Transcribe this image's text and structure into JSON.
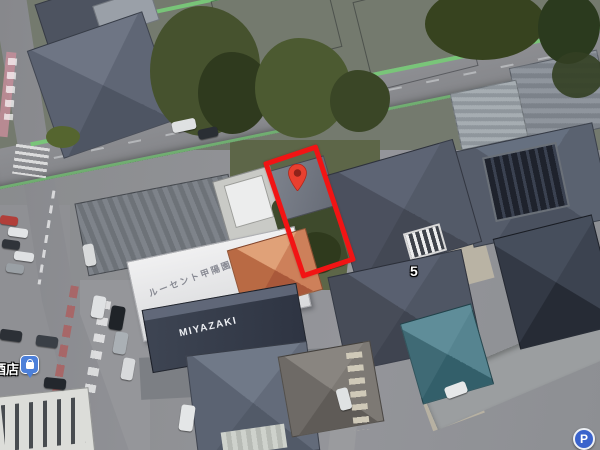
{
  "map_overlay": {
    "view_type": "satellite-aerial",
    "highlight": {
      "shape": "rotated-rectangle-outline",
      "stroke_color": "#f21414"
    },
    "labels": {
      "roof_sign_lucent": "ルーセント甲陽園",
      "roof_sign_miyazaki": "MIYAZAKI",
      "store_label": "酒店",
      "block_number": "5",
      "parking_letter": "P"
    },
    "markers": {
      "property_pin": {
        "icon": "red-map-pin",
        "fill": "#e8402f",
        "inner": "#8f231a"
      },
      "store_marker": {
        "icon": "shopping-bag-pin",
        "fill": "#4d80d9"
      },
      "parking": {
        "icon": "parking-circle",
        "fill": "#3a63cc"
      }
    },
    "road_colors": {
      "asphalt": "#8b8c90",
      "green_edge_line": "#79c579",
      "painted_edge_pink": "#c98f9b"
    }
  }
}
